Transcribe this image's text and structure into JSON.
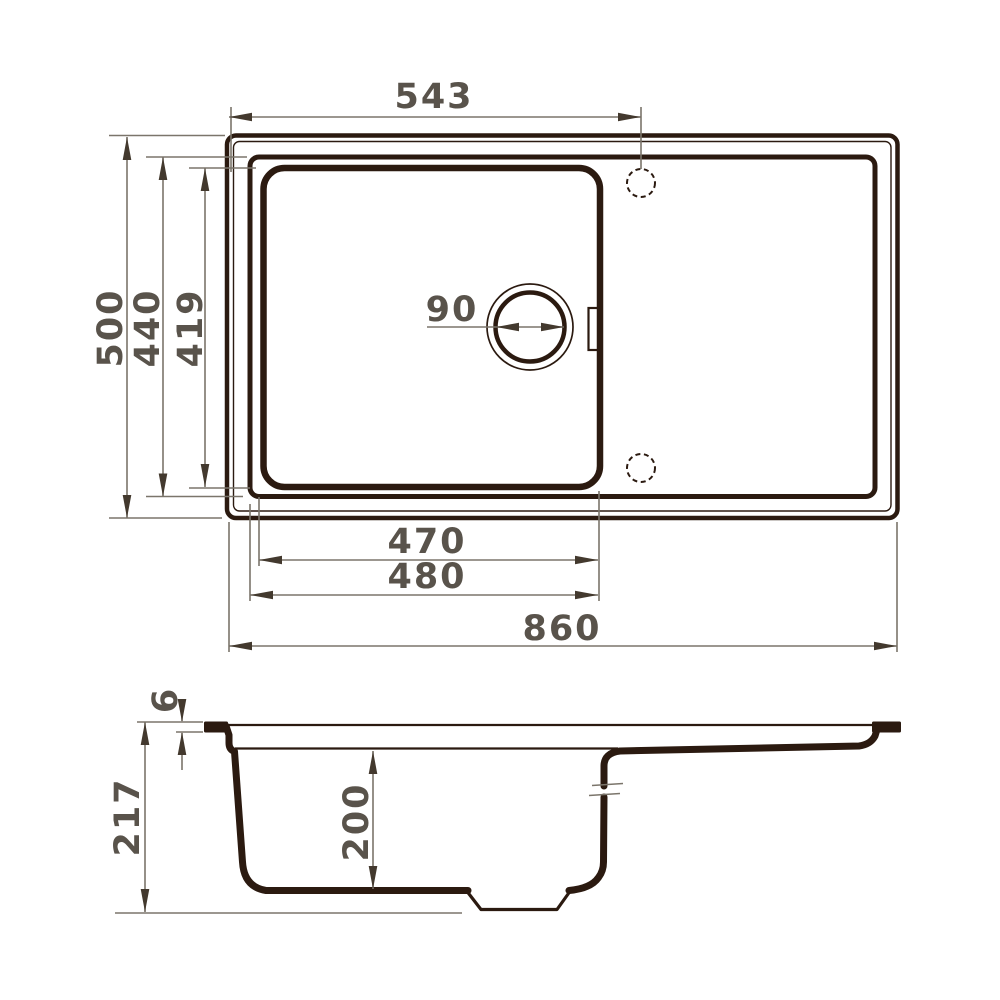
{
  "drawing": {
    "kind": "technical dimension drawing",
    "subject": "kitchen sink with bowl and drainboard, plan view and section view"
  },
  "colors": {
    "outline": "#2b1a10",
    "dimension": "#7b756b",
    "arrow": "#43392e",
    "label": "#59534b"
  },
  "dims": {
    "faucet_center_from_left": "543",
    "overall_front_to_back": "500",
    "rim_front_to_back": "440",
    "bowl_front_to_back": "419",
    "drain_diameter": "90",
    "bowl_width": "470",
    "bowl_width_with_rim": "480",
    "overall_width": "860",
    "edge_thickness": "6",
    "overall_height": "217",
    "bowl_depth": "200"
  }
}
